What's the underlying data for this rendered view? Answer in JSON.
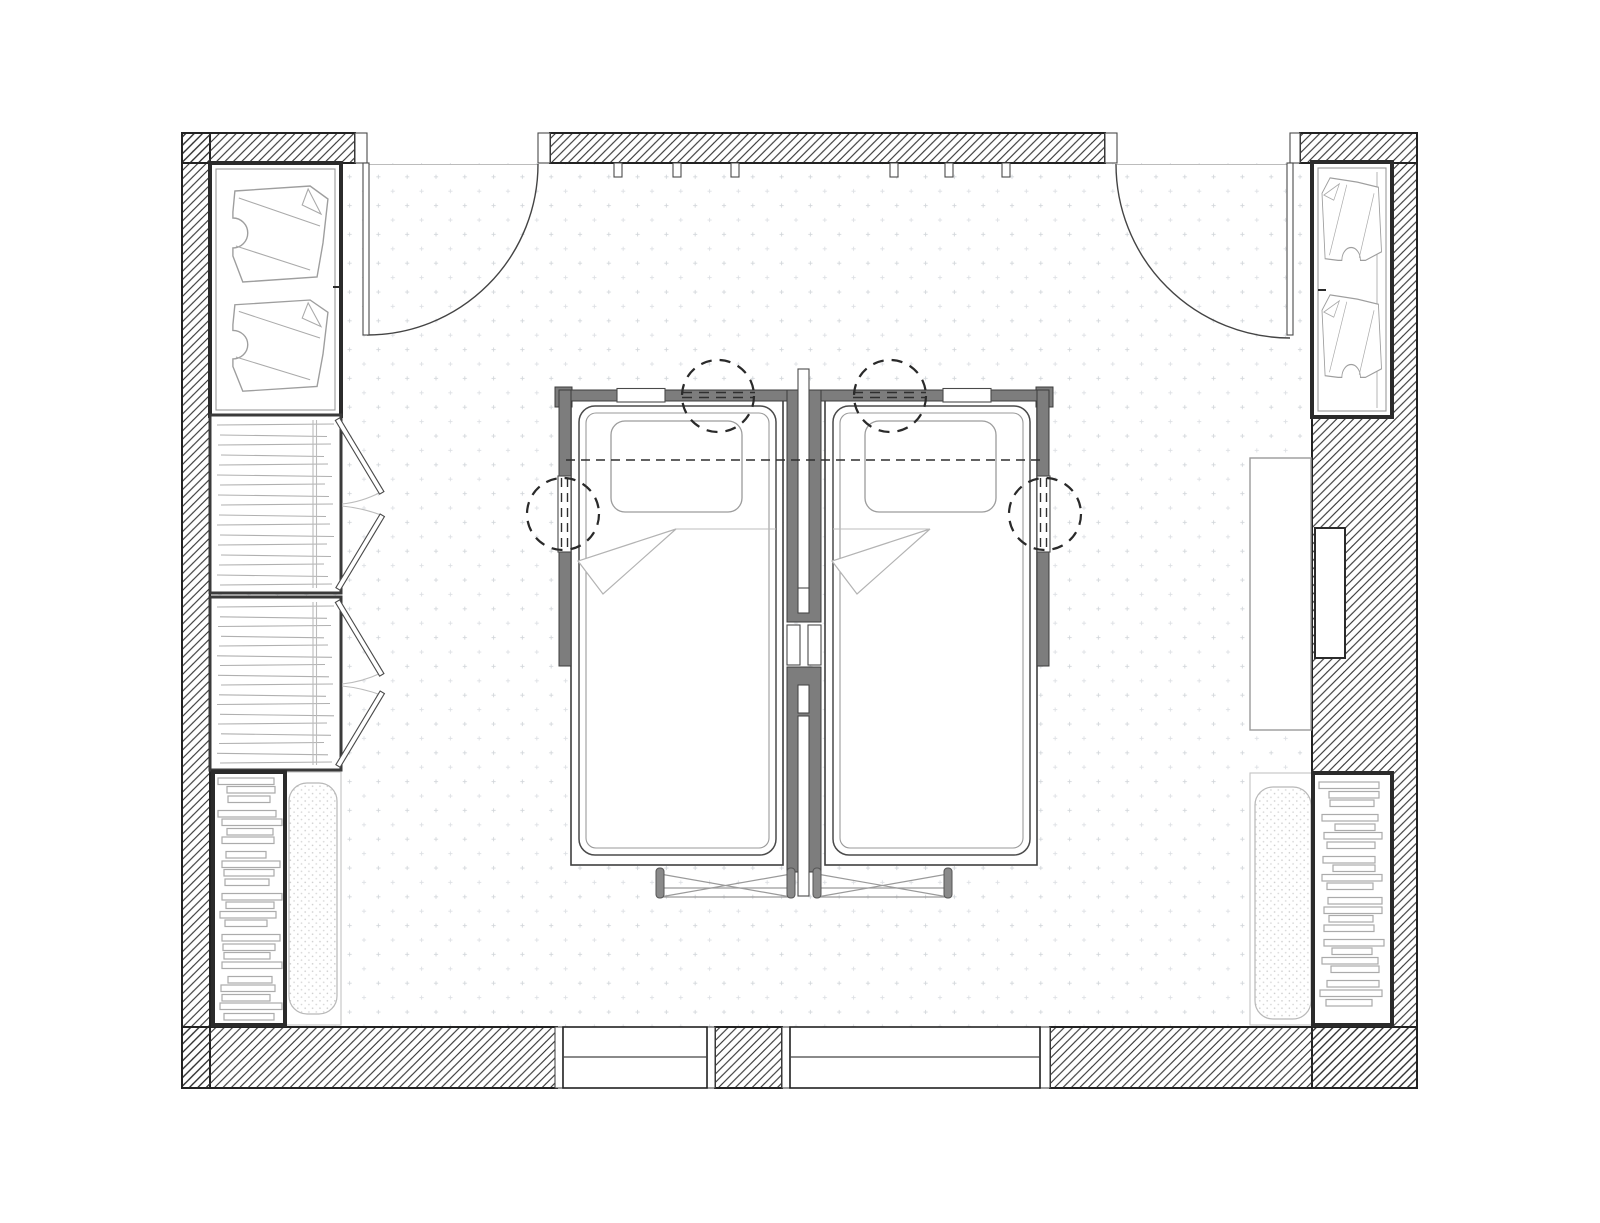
{
  "title": "Twin bedroom floor plan",
  "drawing": {
    "type": "architectural-floor-plan",
    "room": "bedroom with two single beds",
    "view": "top-down plan",
    "style": "black and white line drawing with hatched walls and dotted floor"
  },
  "colors": {
    "paper": "#ffffff",
    "line": "#222222",
    "hatch_line": "#2e2e2e",
    "partition_gray": "#7d7d7d",
    "furniture_dark": "#2b2b2b",
    "furniture_mid": "#3a3a3a",
    "furniture_light": "#9e9e9e",
    "faint": "#bcbcbc",
    "floor_dot": "#d3d7db",
    "cushion_dot": "#cccccc",
    "dash_line": "#2f2f2f"
  },
  "top_wall": {
    "hook_count": 6,
    "hook_x": [
      618,
      677,
      735,
      894,
      949,
      1006
    ]
  },
  "doors": [
    {
      "name": "entry-door-left",
      "hinge": "left",
      "swing": "into room"
    },
    {
      "name": "entry-door-right",
      "hinge": "right",
      "swing": "into room"
    }
  ],
  "windows": [
    {
      "name": "window-1"
    },
    {
      "name": "window-2"
    }
  ],
  "beds": {
    "count": 2,
    "items": [
      {
        "name": "bed-left",
        "pillow": true,
        "blanket_fold": true
      },
      {
        "name": "bed-right",
        "pillow": true,
        "blanket_fold": true
      }
    ],
    "callout_circles": 4
  },
  "wardrobes": {
    "top_left": {
      "shirts": 2
    },
    "top_right": {
      "shirts": 2
    }
  },
  "closets": {
    "count": 2,
    "clothes_lines_per_closet": 17,
    "doors_per_closet": 2
  },
  "bookshelves": {
    "left": {
      "books": [
        [
          56,
          2
        ],
        [
          48,
          3
        ],
        [
          42,
          8
        ],
        [
          58,
          2
        ],
        [
          60,
          3
        ],
        [
          46,
          2
        ],
        [
          52,
          8
        ],
        [
          40,
          3
        ],
        [
          58,
          2
        ],
        [
          50,
          3
        ],
        [
          44,
          8
        ],
        [
          60,
          2
        ],
        [
          48,
          3
        ],
        [
          56,
          2
        ],
        [
          42,
          8
        ],
        [
          58,
          3
        ],
        [
          52,
          2
        ],
        [
          46,
          3
        ],
        [
          60,
          8
        ],
        [
          44,
          2
        ],
        [
          54,
          3
        ],
        [
          48,
          2
        ],
        [
          62,
          4
        ],
        [
          50,
          0
        ]
      ]
    },
    "right": {
      "books": [
        [
          60,
          3
        ],
        [
          50,
          2
        ],
        [
          44,
          8
        ],
        [
          56,
          3
        ],
        [
          40,
          2
        ],
        [
          58,
          3
        ],
        [
          48,
          8
        ],
        [
          52,
          2
        ],
        [
          42,
          3
        ],
        [
          60,
          2
        ],
        [
          46,
          8
        ],
        [
          54,
          3
        ],
        [
          58,
          2
        ],
        [
          44,
          3
        ],
        [
          50,
          8
        ],
        [
          60,
          2
        ],
        [
          40,
          3
        ],
        [
          56,
          2
        ],
        [
          48,
          8
        ],
        [
          52,
          3
        ],
        [
          62,
          3
        ],
        [
          46,
          0
        ]
      ]
    }
  },
  "benches": {
    "count": 2
  },
  "desk": {
    "name": "desk",
    "wall_niche": true
  }
}
